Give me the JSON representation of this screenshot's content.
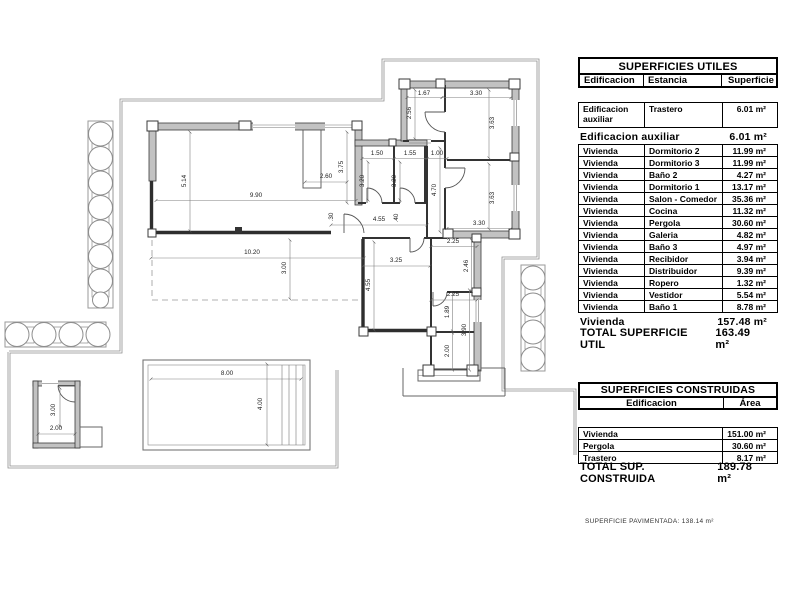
{
  "plan": {
    "dimension_labels": [
      {
        "t": "1.67",
        "x": 424,
        "y": 95
      },
      {
        "t": "3.30",
        "x": 476,
        "y": 95
      },
      {
        "t": "2.56",
        "x": 411,
        "y": 113,
        "v": 1
      },
      {
        "t": "3.63",
        "x": 494,
        "y": 123,
        "v": 1
      },
      {
        "t": "1.50",
        "x": 377,
        "y": 155
      },
      {
        "t": "1.55",
        "x": 410,
        "y": 155
      },
      {
        "t": "1.00",
        "x": 437,
        "y": 155
      },
      {
        "t": "3.20",
        "x": 364,
        "y": 181,
        "v": 1
      },
      {
        "t": "3.20",
        "x": 396,
        "y": 181,
        "v": 1
      },
      {
        "t": "4.70",
        "x": 436,
        "y": 190,
        "v": 1
      },
      {
        "t": "3.75",
        "x": 343,
        "y": 167,
        "v": 1
      },
      {
        "t": "2.60",
        "x": 326,
        "y": 178
      },
      {
        "t": "5.14",
        "x": 186,
        "y": 181,
        "v": 1
      },
      {
        "t": "9.90",
        "x": 256,
        "y": 197
      },
      {
        "t": "3.63",
        "x": 494,
        "y": 198,
        "v": 1
      },
      {
        "t": "3.30",
        "x": 479,
        "y": 225
      },
      {
        "t": "4.55",
        "x": 379,
        "y": 221
      },
      {
        "t": ".40",
        "x": 398,
        "y": 218,
        "v": 1
      },
      {
        "t": ".30",
        "x": 333,
        "y": 217,
        "v": 1
      },
      {
        "t": "10.20",
        "x": 252,
        "y": 254
      },
      {
        "t": "3.00",
        "x": 286,
        "y": 268,
        "v": 1
      },
      {
        "t": "2.25",
        "x": 453,
        "y": 243
      },
      {
        "t": "2.46",
        "x": 468,
        "y": 266,
        "v": 1
      },
      {
        "t": "3.25",
        "x": 396,
        "y": 262
      },
      {
        "t": "4.55",
        "x": 370,
        "y": 285,
        "v": 1
      },
      {
        "t": "2.25",
        "x": 453,
        "y": 296
      },
      {
        "t": "1.89",
        "x": 449,
        "y": 312,
        "v": 1
      },
      {
        "t": "3.90",
        "x": 466,
        "y": 330,
        "v": 1
      },
      {
        "t": "2.00",
        "x": 449,
        "y": 351,
        "v": 1
      },
      {
        "t": "8.00",
        "x": 227,
        "y": 375
      },
      {
        "t": "4.00",
        "x": 262,
        "y": 404,
        "v": 1
      },
      {
        "t": "3.00",
        "x": 55,
        "y": 410,
        "v": 1
      },
      {
        "t": "2.00",
        "x": 56,
        "y": 430
      }
    ]
  },
  "utiles": {
    "title": "SUPERFICIES UTILES",
    "columns": [
      "Edificacion",
      "Estancia",
      "Superficie"
    ],
    "aux_row": [
      "Edificacion\nauxiliar",
      "Trastero",
      "6.01 m²"
    ],
    "subtotal_aux": {
      "label": "Edificacion auxiliar",
      "value": "6.01 m²"
    },
    "rows": [
      [
        "Vivienda",
        "Dormitorio 2",
        "11.99 m²"
      ],
      [
        "Vivienda",
        "Dormitorio 3",
        "11.99 m²"
      ],
      [
        "Vivienda",
        "Baño 2",
        "4.27 m²"
      ],
      [
        "Vivienda",
        "Dormitorio 1",
        "13.17 m²"
      ],
      [
        "Vivienda",
        "Salon - Comedor",
        "35.36 m²"
      ],
      [
        "Vivienda",
        "Cocina",
        "11.32 m²"
      ],
      [
        "Vivienda",
        "Pergola",
        "30.60 m²"
      ],
      [
        "Vivienda",
        "Galeria",
        "4.82 m²"
      ],
      [
        "Vivienda",
        "Baño 3",
        "4.97 m²"
      ],
      [
        "Vivienda",
        "Recibidor",
        "3.94 m²"
      ],
      [
        "Vivienda",
        "Distribuidor",
        "9.39 m²"
      ],
      [
        "Vivienda",
        "Ropero",
        "1.32 m²"
      ],
      [
        "Vivienda",
        "Vestidor",
        "5.54 m²"
      ],
      [
        "Vivienda",
        "Baño 1",
        "8.78 m²"
      ]
    ],
    "subtotal_vivienda": {
      "label": "Vivienda",
      "value": "157.48 m²"
    },
    "total": {
      "label": "TOTAL SUPERFICIE UTIL",
      "value": "163.49 m²"
    }
  },
  "construidas": {
    "title": "SUPERFICIES CONSTRUIDAS",
    "columns": [
      "Edificacion",
      "Área"
    ],
    "rows": [
      [
        "Vivienda",
        "151.00 m²"
      ],
      [
        "Pergola",
        "30.60 m²"
      ],
      [
        "Trastero",
        "8.17 m²"
      ]
    ],
    "total": {
      "label": "TOTAL SUP. CONSTRUIDA",
      "value": "189.78 m²"
    }
  },
  "footer_note": "SUPERFICIE PAVIMENTADA: 138.14 m²",
  "colors": {
    "wall_fill": "#c2c2c2",
    "wall_edge": "#3a3a3a",
    "boundary": "#8f8f8f",
    "dim_text": "#222222",
    "table_text": "#000000",
    "background": "#ffffff"
  }
}
